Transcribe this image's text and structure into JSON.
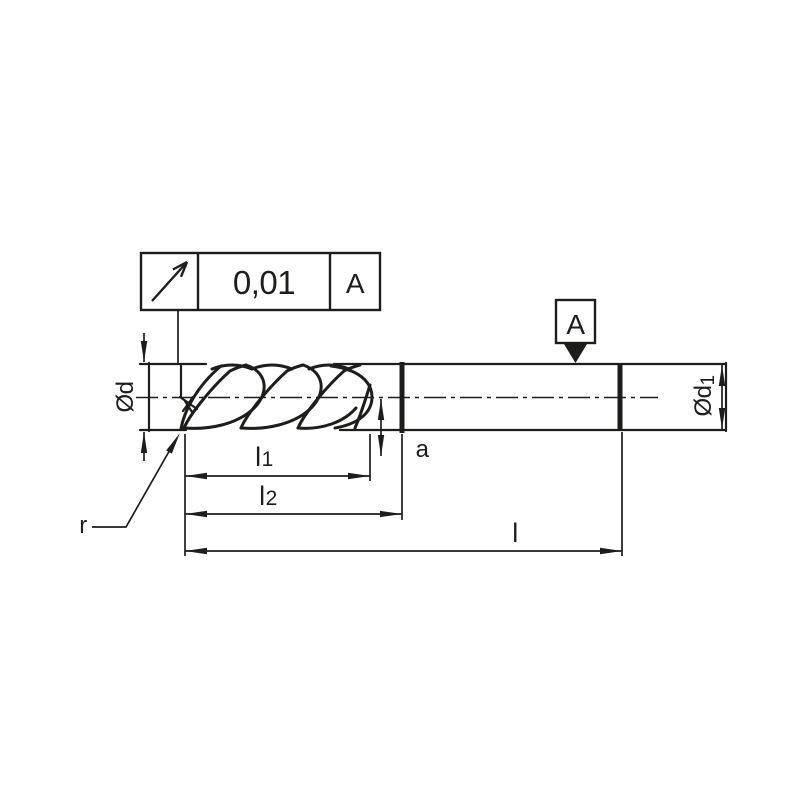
{
  "meta": {
    "description": "Technical dimension drawing of a corner-radius end mill with circular runout tolerance"
  },
  "colors": {
    "ink": "#1d1d1b",
    "background": "#ffffff"
  },
  "tolerance_frame": {
    "symbol_icon": "circular-runout-arrow-icon",
    "value": "0,01",
    "datum_ref": "A"
  },
  "datum_symbol": {
    "label": "A"
  },
  "dimensions": {
    "diameter_label": "Ød",
    "shank_diameter_base": "Ød",
    "shank_diameter_sub": "1",
    "flute_length_base": "l",
    "flute_length_sub": "1",
    "neck_length_base": "l",
    "neck_length_sub": "2",
    "overall_length_label": "l",
    "end_offset_label": "a",
    "corner_radius_label": "r"
  }
}
